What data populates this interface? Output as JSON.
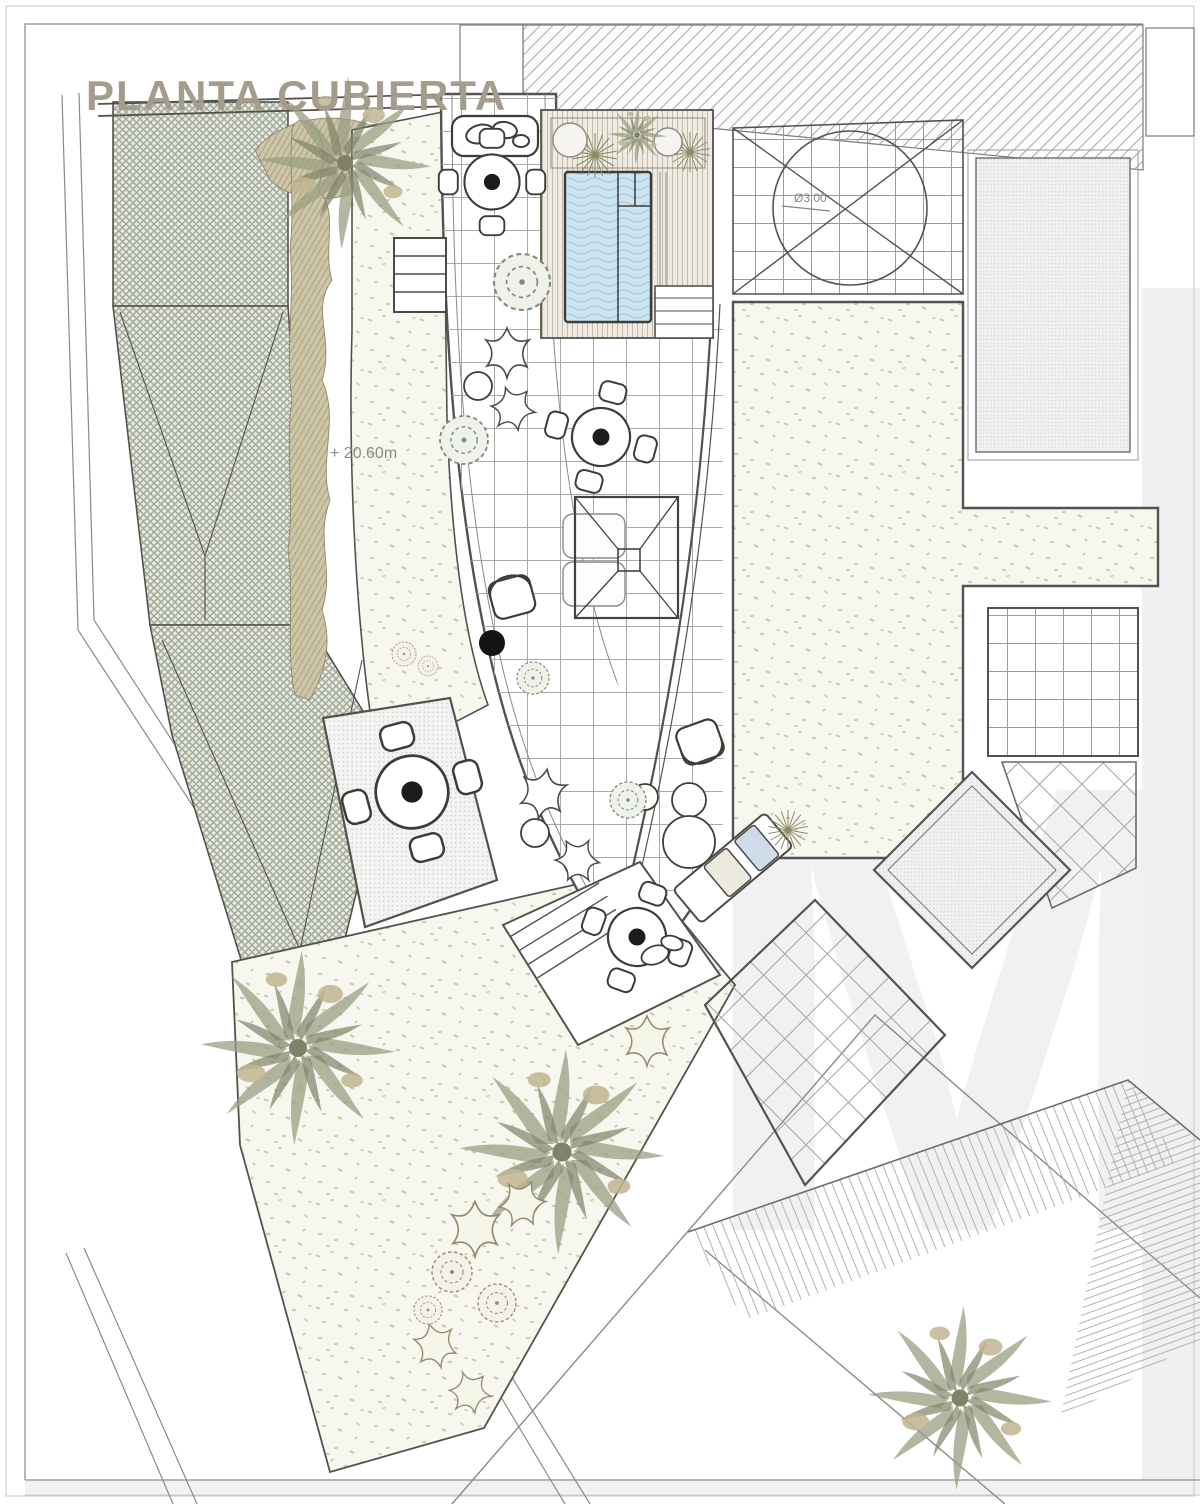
{
  "page": {
    "title": "PLANTA CUBIERTA",
    "watermark_letter": "M"
  },
  "annotations": {
    "roof_level": "+ 20.60m",
    "skylight_diameter": "Ø3.00"
  },
  "palette": {
    "paper": "#ffffff",
    "ink": "#55524e",
    "title_text": "#a49d8d",
    "annotation_text": "#8b8b82",
    "pool_water": "#cbe4f0",
    "pool_wave": "#9ec6da",
    "roof_crosshatch": "#a0a896",
    "hedge_tan": "#cdc5a7",
    "vegetation_olive": "#8f927b",
    "gravel_speckle": "#ccccaa",
    "deck_stripe": "#c3bbaa",
    "watermark_gray": "#f1f1f4"
  }
}
